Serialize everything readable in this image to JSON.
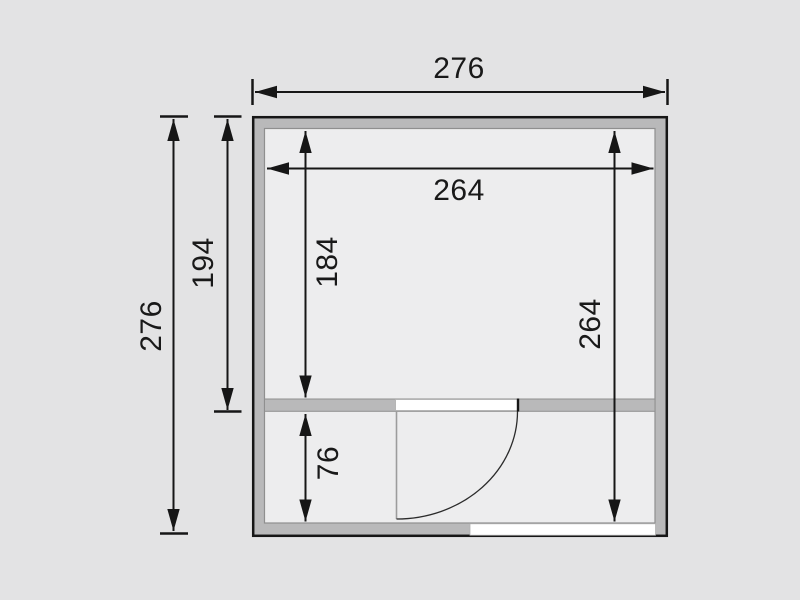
{
  "drawing": {
    "type": "floor-plan",
    "description": "Top-view floor plan with walls, an inner partition, a hinged door swing arc and dimension arrows",
    "colors": {
      "background": "#e3e3e4",
      "room_fill": "#ededee",
      "wall_fill": "#b9b9ba",
      "line": "#191919",
      "door_leaf_line": "#9c9c9c",
      "opening_fill": "#ffffff"
    },
    "rooms": [
      "rear-room",
      "front-room"
    ],
    "dimensions": [
      {
        "value": "276",
        "orientation": "horizontal",
        "position": "top-outside",
        "measures": "overall-width"
      },
      {
        "value": "276",
        "orientation": "vertical",
        "position": "left-outside",
        "measures": "overall-depth"
      },
      {
        "value": "194",
        "orientation": "vertical",
        "position": "left-outside-inner",
        "measures": "rear-room-depth-incl-walls"
      },
      {
        "value": "264",
        "orientation": "horizontal",
        "position": "inside-top",
        "measures": "inner-width"
      },
      {
        "value": "184",
        "orientation": "vertical",
        "position": "inside-left",
        "measures": "rear-room-inner-depth"
      },
      {
        "value": "264",
        "orientation": "vertical",
        "position": "inside-right",
        "measures": "inner-depth"
      },
      {
        "value": "76",
        "orientation": "vertical",
        "position": "inside-bottom-left",
        "measures": "front-room-inner-depth"
      }
    ]
  }
}
